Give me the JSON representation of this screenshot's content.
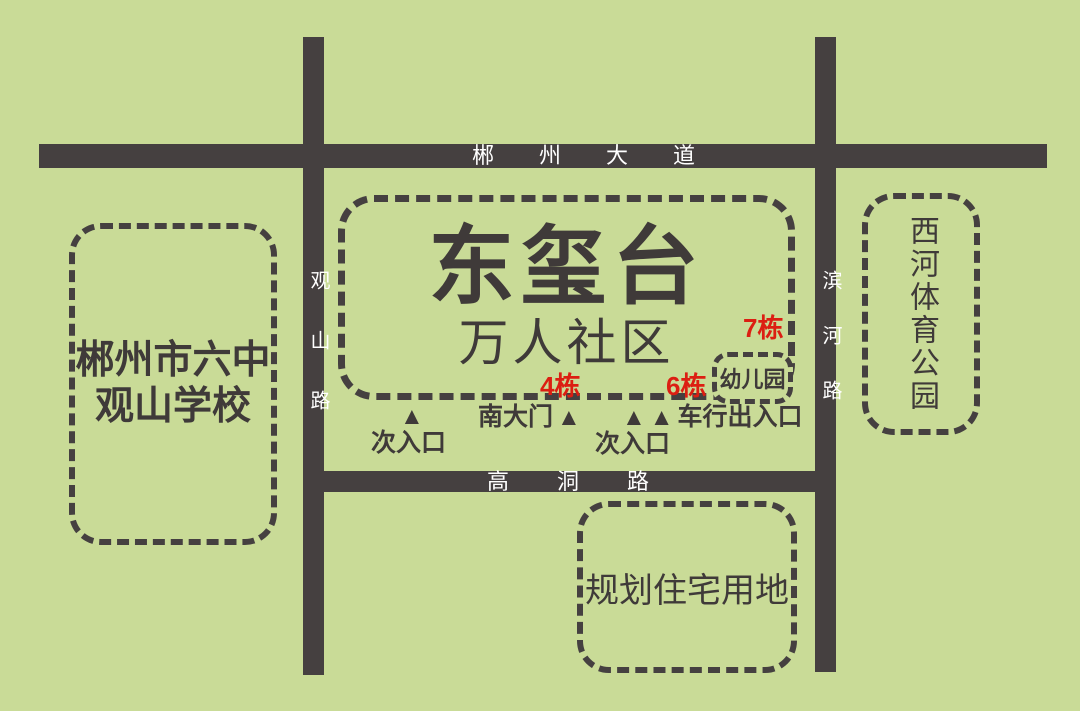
{
  "colors": {
    "background": "#c9db97",
    "road": "#454040",
    "ink": "#3f3a39",
    "road_label": "#ffffff",
    "accent_red": "#dc1e12"
  },
  "roads": {
    "chenzhou_avenue": "郴州大道",
    "gaodong_road": "高洞路",
    "guanshan_road": "观山路",
    "binhe_road": "滨河路"
  },
  "areas": {
    "school": {
      "line1": "郴州市六中",
      "line2": "观山学校"
    },
    "community": {
      "title": "东玺台",
      "subtitle": "万人社区"
    },
    "park": {
      "name": "西河体育公园"
    },
    "planned": {
      "name": "规划住宅用地"
    },
    "kindergarten": {
      "name": "幼儿园"
    }
  },
  "buildings": {
    "b4": "4栋",
    "b6": "6栋",
    "b7": "7栋"
  },
  "entrances": {
    "marker": "▲",
    "secondary1": "次入口",
    "south_gate": "南大门",
    "vehicle": "车行出入口",
    "secondary2": "次入口"
  }
}
